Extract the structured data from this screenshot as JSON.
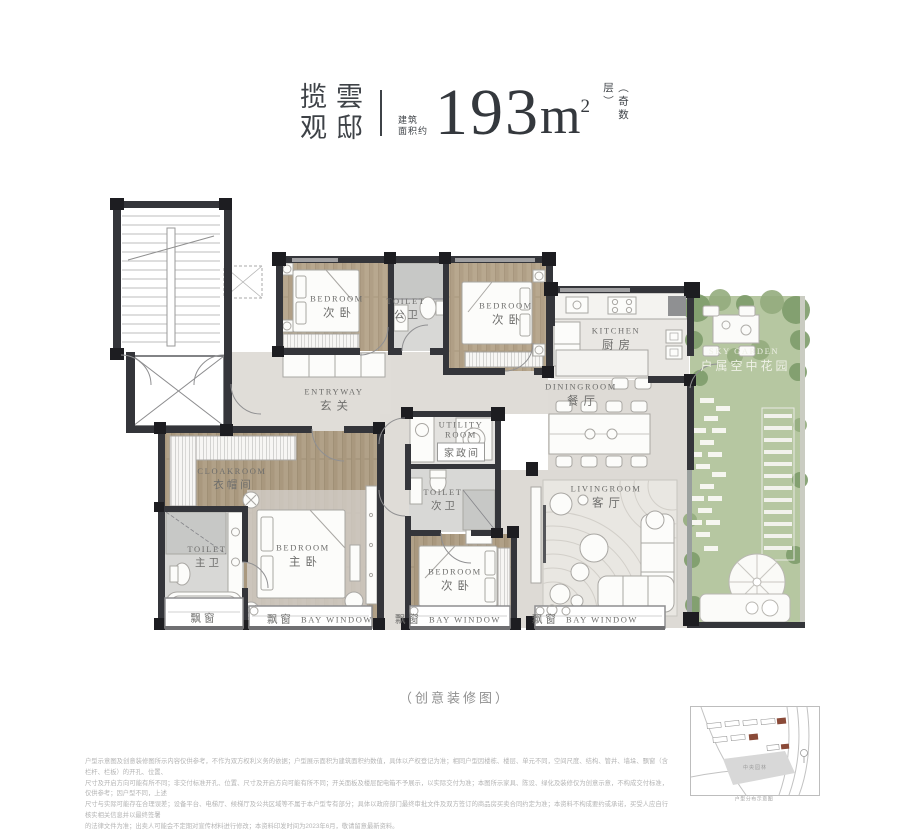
{
  "header": {
    "brand_col1": "揽雲",
    "brand_col2": "观邸",
    "area_prefix": [
      "建筑",
      "面积约"
    ],
    "area_value": "193",
    "area_unit": "m",
    "area_exponent": "2",
    "floor_note": "（奇数层）"
  },
  "rooms": [
    {
      "id": "bedroom-north-left",
      "en": "BEDROOM",
      "zh": "次卧"
    },
    {
      "id": "public-toilet",
      "en": "TOILET",
      "zh": "公卫"
    },
    {
      "id": "bedroom-north-right",
      "en": "BEDROOM",
      "zh": "次卧"
    },
    {
      "id": "kitchen",
      "en": "KITCHEN",
      "zh": "厨房"
    },
    {
      "id": "dining-room",
      "en": "DININGROOM",
      "zh": "餐厅"
    },
    {
      "id": "sky-garden",
      "en": "SKY GARDEN",
      "zh": "户属空中花园"
    },
    {
      "id": "entryway",
      "en": "ENTRYWAY",
      "zh": "玄关"
    },
    {
      "id": "utility-room",
      "en": "UTILITY ROOM",
      "zh": "家政间"
    },
    {
      "id": "second-toilet",
      "en": "TOILET",
      "zh": "次卫"
    },
    {
      "id": "cloakroom",
      "en": "CLOAKROOM",
      "zh": "衣帽间"
    },
    {
      "id": "master-toilet",
      "en": "TOILET",
      "zh": "主卫"
    },
    {
      "id": "master-bedroom",
      "en": "BEDROOM",
      "zh": "主卧"
    },
    {
      "id": "bedroom-south",
      "en": "BEDROOM",
      "zh": "次卧"
    },
    {
      "id": "living-room",
      "en": "LIVINGROOM",
      "zh": "客厅"
    }
  ],
  "bay": {
    "zh": "飘窗",
    "en": "BAY WINDOW"
  },
  "caption": "（创意装修图）",
  "disclaimer": {
    "line1": "户型示意图及创意装修图所示内容仅供参考，不作为双方权利义务的依据；户型展示面积为建筑面积约数值，具体以产权登记为准；相同户型因楼栋、楼层、单元不同，空间尺度、结构、管井、墙垛、飘窗（含栏杆、栏板）的开孔、位置、",
    "line2": "尺寸及开启方向可能有所不同；非交付标准开孔、位置、尺寸及开启方向可能有所不同；开关面板及楼层配电箱不予展示，以实际交付为准；本图所示家具、陈设、绿化及装修仅为创意示意，不构成交付标准，仅供参考；因户型不同，上述",
    "line3": "尺寸与实际可能存在合理误差；设备平台、电梯厅、候梯厅及公共区域等不属于本户型专有部分；具体以政府部门最终审批文件及双方签订的商品房买卖合同约定为准；本资料不构成要约或承诺，买受人应自行核实相关信息并以最终签署",
    "line4": "的法律文件为准；出卖人可能会不定期对宣传材料进行修改；本资料印发时间为2023年6月，敬请留意最新资料。"
  },
  "site_map": {
    "area_label": "中央园林",
    "caption": "户型分布示意图"
  },
  "colors": {
    "wall": "#34353a",
    "column": "#1d1d21",
    "wood": "#b8a88f",
    "marble": "#dfdcd7",
    "grass": "#b6c7a1",
    "highlight_building": "#8a4a38",
    "title_text": "#3e4247"
  }
}
